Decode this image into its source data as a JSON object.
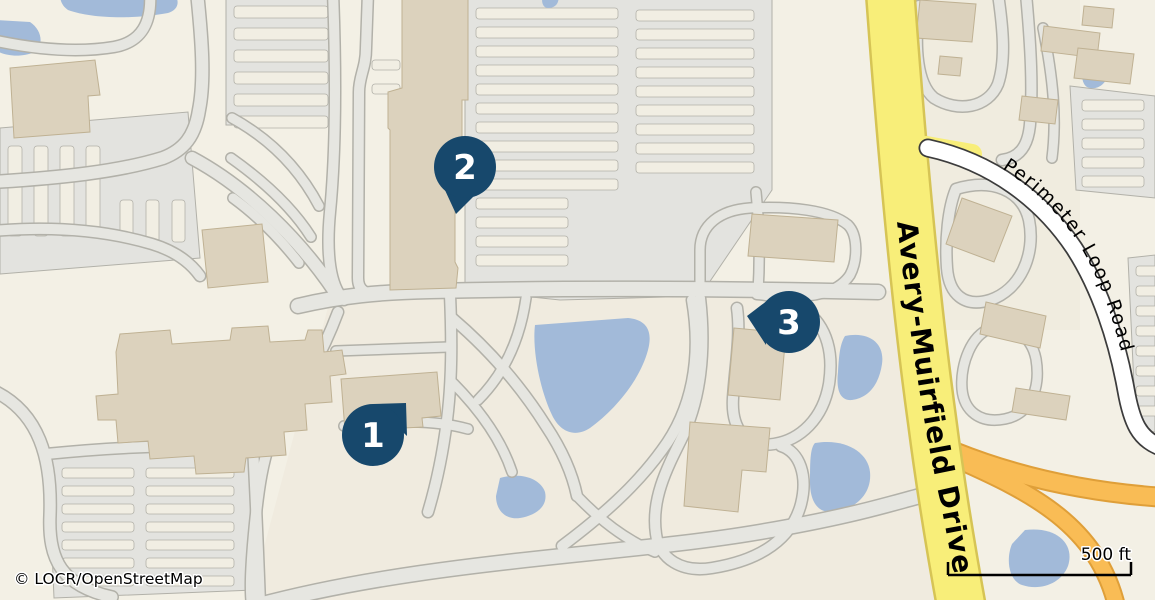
{
  "map": {
    "attribution": "© LOCR/OpenStreetMap",
    "scale_label": "500 ft",
    "roads": {
      "primary": "Avery-Muirfield Drive",
      "secondary": "Perimeter Loop Road"
    },
    "markers": [
      {
        "label": "1"
      },
      {
        "label": "2"
      },
      {
        "label": "3"
      }
    ],
    "colors": {
      "background": "#f3f0e5",
      "parking": "#e3e3df",
      "parking_island": "#f1eee3",
      "road_minor": "#e6e6e1",
      "road_casing": "#b2b1a9",
      "road_primary": "#f8ee79",
      "road_primary_casing": "#d6c455",
      "road_secondary": "#ffffff",
      "road_secondary_casing": "#3c3c3c",
      "ramp": "#f9bc55",
      "ramp_casing": "#df9f39",
      "water": "#a2bad9",
      "building": "#dcd2bd",
      "building_outline": "#bfb193",
      "marker": "#17486c",
      "marker_text": "#ffffff",
      "label_text": "#000000"
    }
  }
}
